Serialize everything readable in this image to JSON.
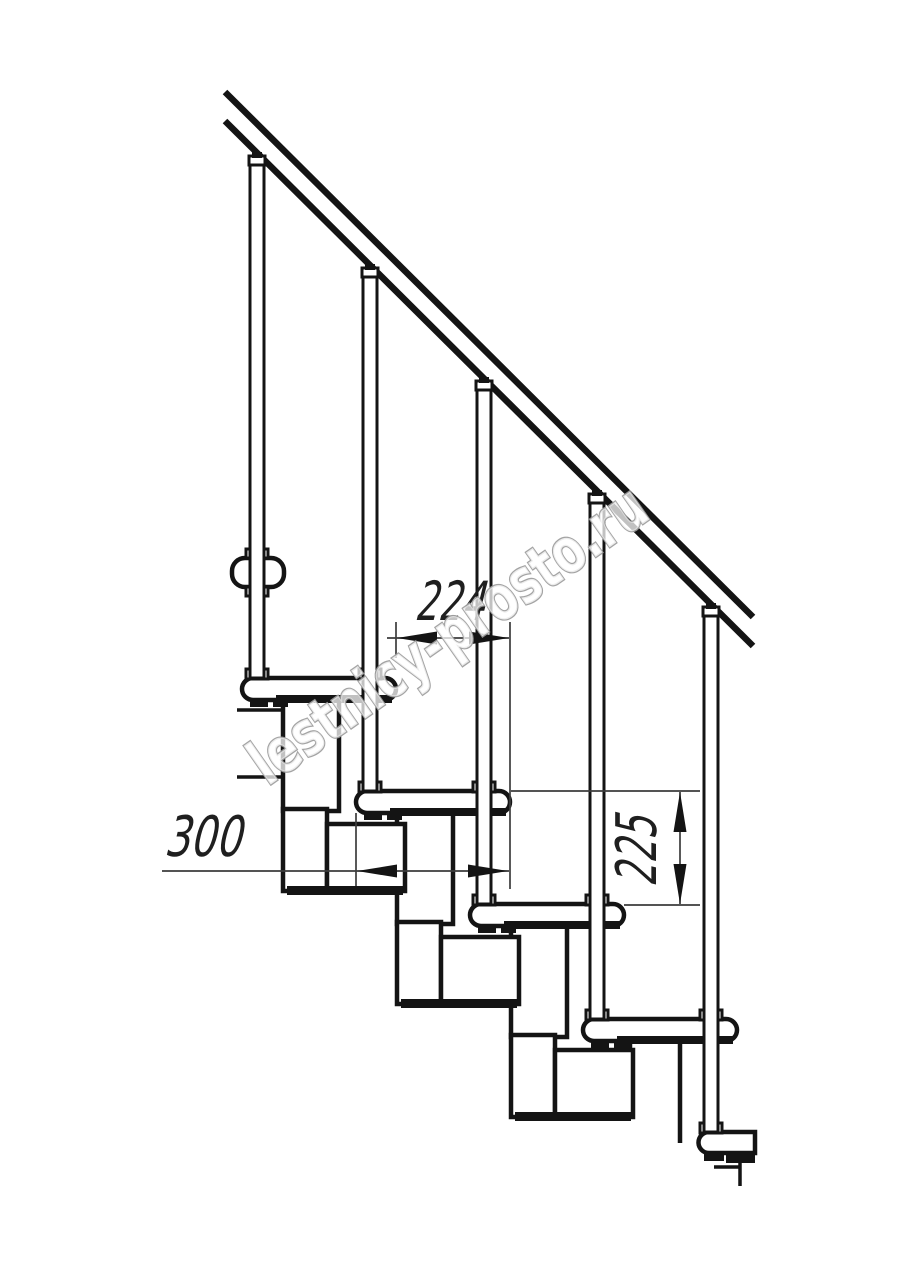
{
  "drawing": {
    "description": "modular staircase side elevation",
    "dimensions": {
      "step_run": "224",
      "tread_depth": "300",
      "step_rise": "225"
    },
    "watermark": {
      "text": "lestnicy-prosto.ru"
    },
    "colors": {
      "line": "#141414",
      "fill_black": "#141414",
      "dimension_line": "#3c3c3c",
      "dimension_text": "#1f1f1f",
      "watermark_stroke": "#9d9d9d",
      "background": "#ffffff"
    }
  }
}
